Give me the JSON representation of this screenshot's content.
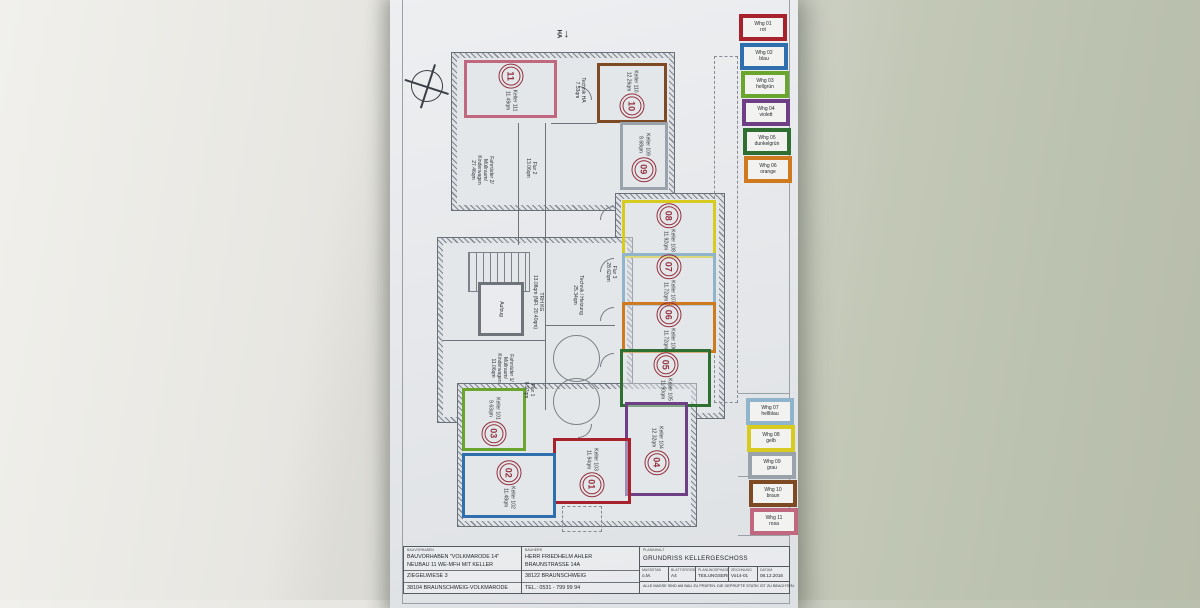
{
  "plan": {
    "title_hint": "GRUNDRISS KELLERGESCHOSS",
    "ha_label": "HA",
    "ha_arrow": "↓",
    "unit_badge_color": "#94303d",
    "rooms": [
      {
        "unit": "11",
        "name": "Keller 111",
        "area": "11.49qm",
        "color": "#bf6880",
        "color_name": "rosa"
      },
      {
        "unit": "10",
        "name": "Keller 110",
        "area": "12.26qm",
        "color": "#7d4a23",
        "color_name": "braun"
      },
      {
        "unit": "09",
        "name": "Keller 109",
        "area": "8.68qm",
        "color": "#9aa2ab",
        "color_name": "grau"
      },
      {
        "unit": "08",
        "name": "Keller 108",
        "area": "11.92qm",
        "color": "#d6cb1e",
        "color_name": "gelb"
      },
      {
        "unit": "07",
        "name": "Keller 107",
        "area": "11.72qm",
        "color": "#8fb4cc",
        "color_name": "hellblau"
      },
      {
        "unit": "06",
        "name": "Keller 106",
        "area": "11.72qm",
        "color": "#cf7a1f",
        "color_name": "orange"
      },
      {
        "unit": "05",
        "name": "Keller 105",
        "area": "11.90qm",
        "color": "#2f7032",
        "color_name": "dunkelgrün"
      },
      {
        "unit": "04",
        "name": "Keller 104",
        "area": "12.32qm",
        "color": "#6f3f85",
        "color_name": "violett"
      },
      {
        "unit": "01",
        "name": "Keller 103",
        "area": "11.94qm",
        "color": "#a8222e",
        "color_name": "rot"
      },
      {
        "unit": "02",
        "name": "Keller 102",
        "area": "11.48qm",
        "color": "#2f6fad",
        "color_name": "blau"
      },
      {
        "unit": "03",
        "name": "Keller 101",
        "area": "9.63qm",
        "color": "#6aa62e",
        "color_name": "hellgrün"
      }
    ],
    "spaces": {
      "technik_ha": {
        "name": "Technik HA",
        "area": "7.33qm"
      },
      "fahrraeder_2": {
        "name": "Fahrräder 2/ Müllraum/ Kinderwagen",
        "area": "27.46qm"
      },
      "flur_2": {
        "name": "Flur 2",
        "area": "13.06qm"
      },
      "flur_3": {
        "name": "Flur 3",
        "area": "28.62qm"
      },
      "aufzug": {
        "name": "Aufzug",
        "area": ""
      },
      "trh": {
        "name": "TRH KG",
        "area": "13.08qm (NFl. 20.40qm)"
      },
      "technik_heizung": {
        "name": "Technik / Heizung",
        "area": "25.34qm"
      },
      "fahrraeder_1": {
        "name": "Fahrräder 1/ Müllraum/ Kinderwagen",
        "area": "11.06qm"
      },
      "flur_1": {
        "name": "Flur 1",
        "area": "8.97qm"
      }
    }
  },
  "legend": {
    "top_items": [
      {
        "label": "Whg 01",
        "color_name": "rot",
        "color": "#a8222e"
      },
      {
        "label": "Whg 02",
        "color_name": "blau",
        "color": "#2f6fad"
      },
      {
        "label": "Whg 03",
        "color_name": "hellgrün",
        "color": "#6aa62e"
      },
      {
        "label": "Whg 04",
        "color_name": "violett",
        "color": "#6f3f85"
      },
      {
        "label": "Whg 05",
        "color_name": "dunkelgrün",
        "color": "#2f7032"
      },
      {
        "label": "Whg 06",
        "color_name": "orange",
        "color": "#cf7a1f"
      }
    ],
    "bottom_items": [
      {
        "label": "Whg 07",
        "color_name": "hellblau",
        "color": "#8fb4cc"
      },
      {
        "label": "Whg 08",
        "color_name": "gelb",
        "color": "#d6cb1e"
      },
      {
        "label": "Whg 09",
        "color_name": "grau",
        "color": "#9aa2ab"
      },
      {
        "label": "Whg 10",
        "color_name": "braun",
        "color": "#7d4a23"
      },
      {
        "label": "Whg 11",
        "color_name": "rosa",
        "color": "#bf6880"
      }
    ]
  },
  "titleblock": {
    "project": {
      "label": "BAUVORHABEN",
      "lines": [
        "BAUVORHABEN \"VOLKMARODE 14\"",
        "NEUBAU 11 WE-MFH MIT KELLER",
        "ZIEGELWIESE 3",
        "38104 BRAUNSCHWEIG-VOLKMARODE"
      ]
    },
    "client": {
      "label": "BAUHERR",
      "lines": [
        "HERR FRIEDHELM AHLER",
        "BRAUNSTRASSE 14A",
        "38122 BRAUNSCHWEIG",
        "TEL.: 0531 - 799 99 94"
      ]
    },
    "content": {
      "label": "PLANINHALT",
      "title": "GRUNDRISS KELLERGESCHOSS"
    },
    "fields": [
      {
        "label": "MASSSTAB",
        "value": "o.M."
      },
      {
        "label": "BLATTGRÖSSE",
        "value": "A4"
      },
      {
        "label": "PLANUNGSPHASE",
        "value": "TEILUNGSERKL."
      },
      {
        "label": "ZEICHNUNG",
        "value": "Vo14-01"
      },
      {
        "label": "DATUM",
        "value": "08.12.2016"
      }
    ],
    "note": "ALLE MASSE SIND AM BAU ZU PRÜFEN. DIE GEPRÜFTE STATIK IST ZU BEACHTEN."
  }
}
